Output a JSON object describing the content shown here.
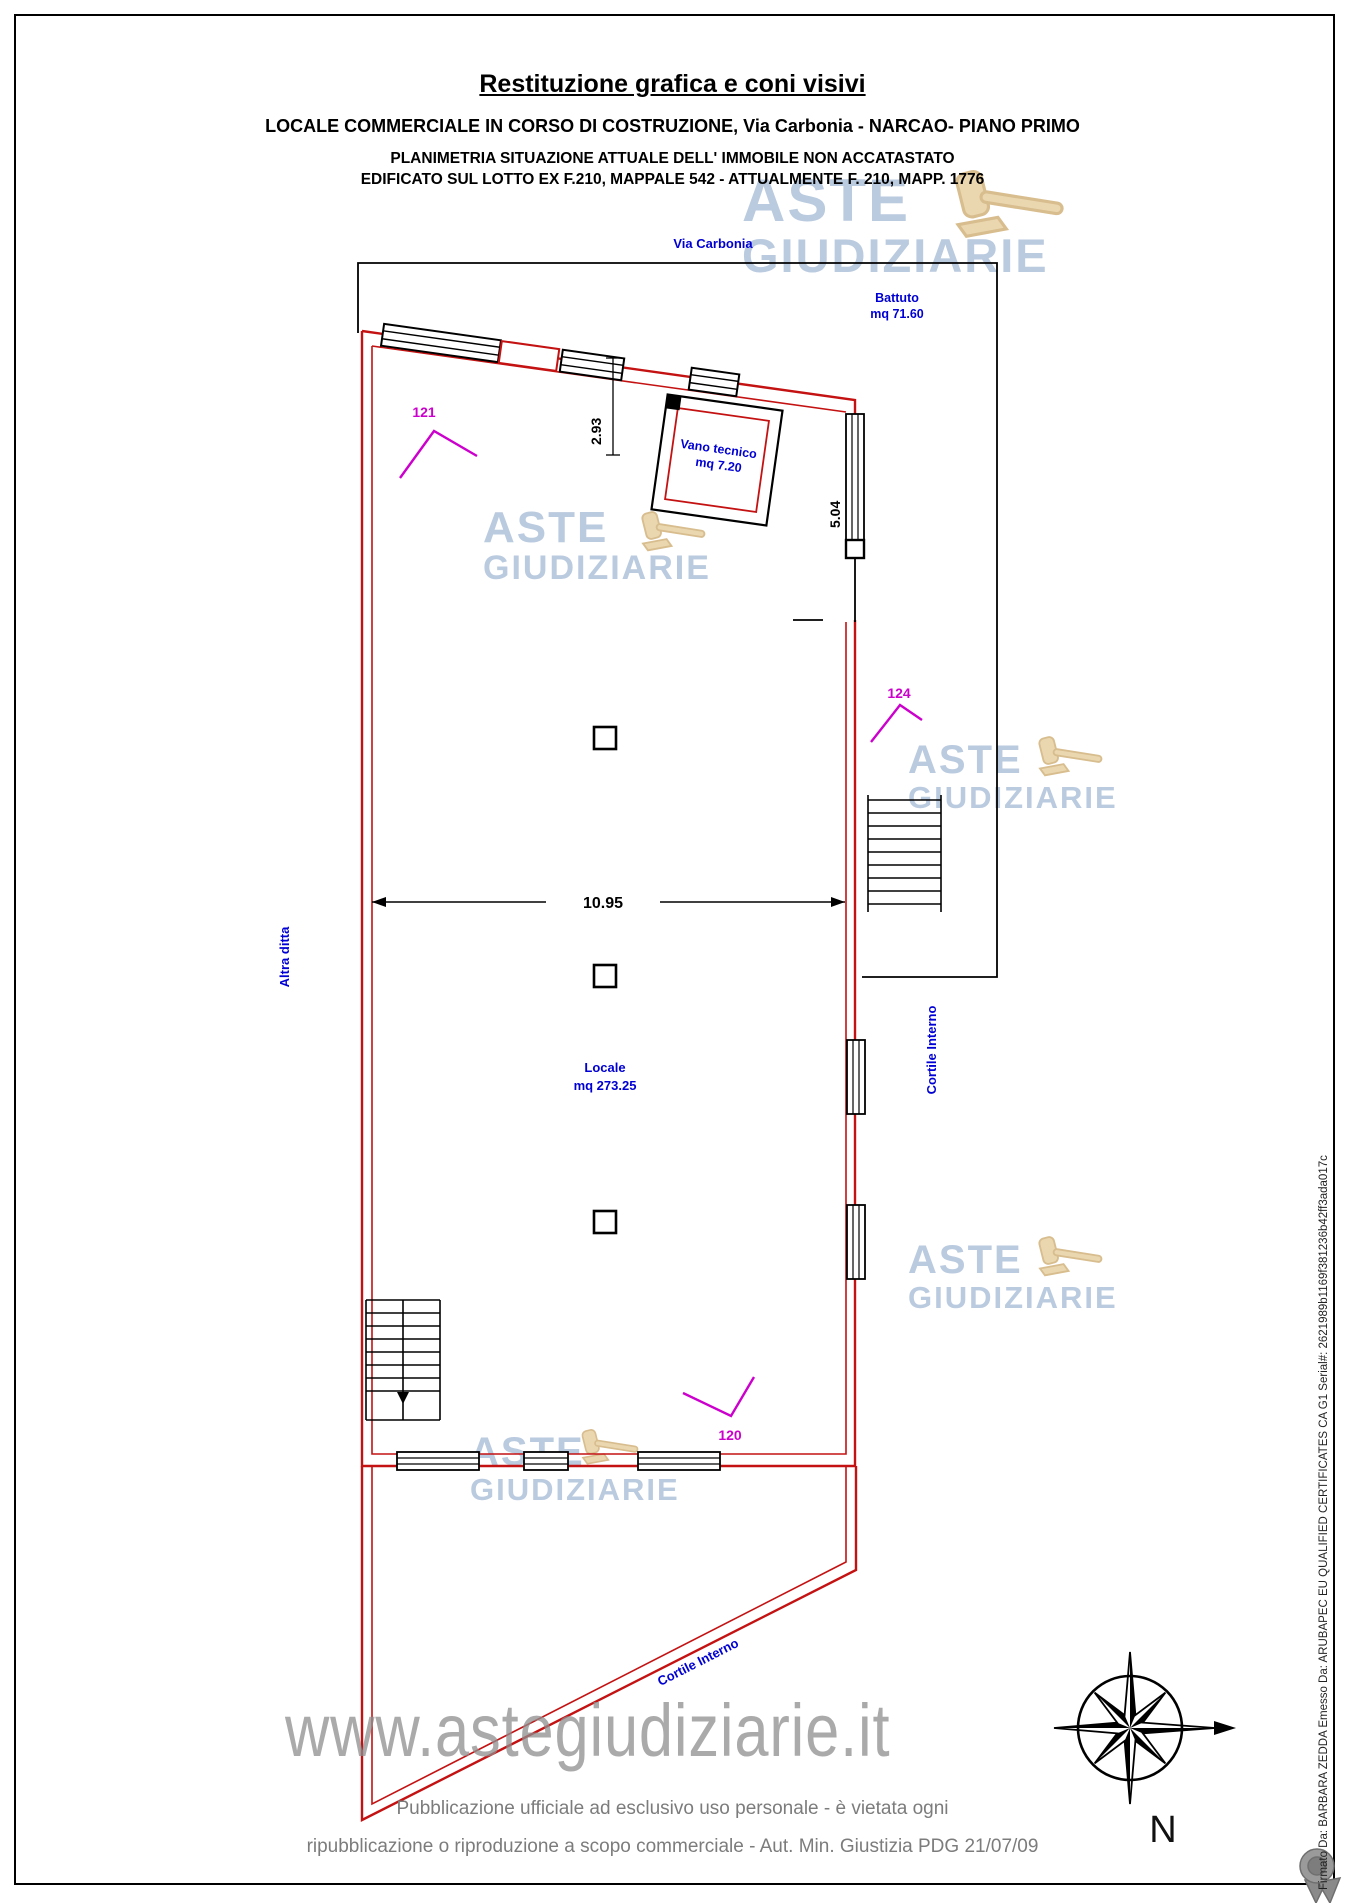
{
  "header": {
    "title": "Restituzione grafica e coni visivi",
    "line2": "LOCALE COMMERCIALE IN CORSO DI COSTRUZIONE, Via Carbonia - NARCAO- PIANO PRIMO",
    "line3": "PLANIMETRIA SITUAZIONE ATTUALE DELL' IMMOBILE NON ACCATASTATO",
    "line4": "EDIFICATO SUL LOTTO EX F.210, MAPPALE 542 - ATTUALMENTE F. 210, MAPP. 1776"
  },
  "plan": {
    "street": "Via Carbonia",
    "battuto": {
      "name": "Battuto",
      "area": "mq 71.60"
    },
    "vano": {
      "name": "Vano tecnico",
      "area": "mq 7.20"
    },
    "locale": {
      "name": "Locale",
      "area": "mq 273.25"
    },
    "left_label": "Altra ditta",
    "right_label": "Cortile Interno",
    "bottom_label": "Cortile Interno",
    "dim_width": "10.95",
    "dim_top": "2.93",
    "dim_right": "5.04",
    "marker_121": "121",
    "marker_124": "124",
    "marker_120": "120",
    "compass": "N"
  },
  "watermark": {
    "word1": "ASTE",
    "word2": "GIUDIZIARIE",
    "site": "www.astegiudiziarie.it"
  },
  "footer": {
    "line1": "Pubblicazione ufficiale ad esclusivo uso personale - è vietata ogni",
    "line2": "ripubblicazione o riproduzione a scopo commerciale - Aut. Min. Giustizia PDG 21/07/09"
  },
  "signature": "Firmato Da: BARBARA ZEDDA Emesso Da: ARUBAPEC EU QUALIFIED CERTIFICATES CA G1 Serial#: 2621989b1169f381236b42ff3ada017c",
  "colors": {
    "wall": "#c41212",
    "label": "#0000d4",
    "marker": "#cc00cc",
    "watermark_blue": "#a9bdd8",
    "watermark_grey": "#8e8e8e"
  }
}
